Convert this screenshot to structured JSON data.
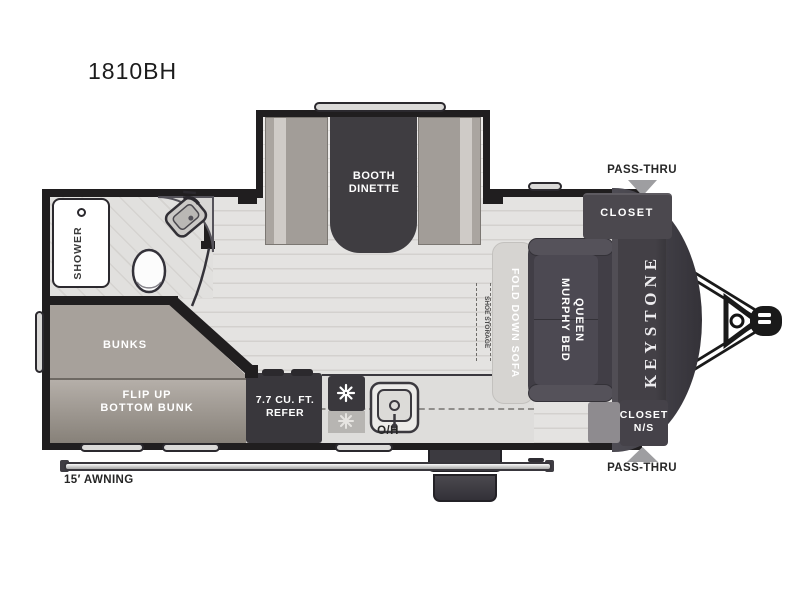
{
  "title": "1810BH",
  "brand": "KEYSTONE",
  "colors": {
    "wall": "#201e1f",
    "front_cap": "#413f46",
    "floor": "#e4e3e1",
    "furniture_dark": "#413e46",
    "bunk_gray": "#a7a19b",
    "label_white": "#ffffff",
    "arrow_gray": "#9e9ea1"
  },
  "labels": {
    "slide_dinette": "BOOTH\nDINETTE",
    "shower": "SHOWER",
    "bunks": "BUNKS",
    "flip_bunk": "FLIP UP\nBOTTOM BUNK",
    "refer": "7.7 CU. FT.\nREFER",
    "overhead": "O/H",
    "fold_sofa": "FOLD DOWN SOFA",
    "shoe_storage": "SHOE STORAGE",
    "murphy_bed": "QUEEN\nMURPHY BED",
    "closet_front": "CLOSET",
    "closet_ns": "CLOSET\nN/S",
    "pass_thru_top": "PASS-THRU",
    "pass_thru_bottom": "PASS-THRU",
    "awning": "15′ AWNING"
  }
}
